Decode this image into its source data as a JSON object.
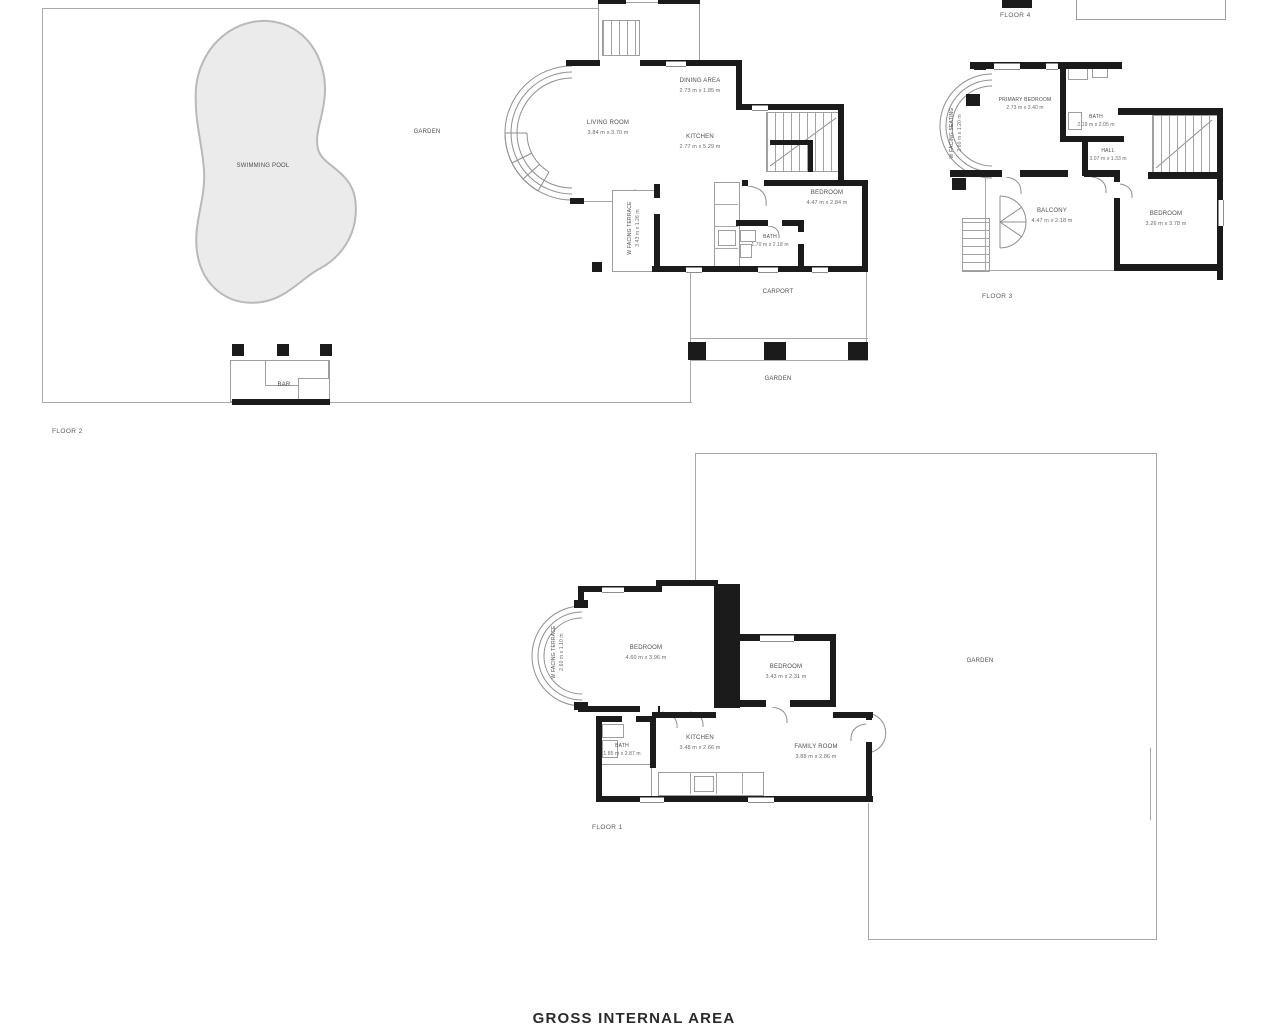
{
  "sheet": {
    "bottom_caption": "GROSS INTERNAL AREA"
  },
  "floor2": {
    "name": "FLOOR 2",
    "garden_label": "GARDEN",
    "garden_lower_label": "GARDEN",
    "pool_label": "SWIMMING POOL",
    "bar_label": "BAR",
    "carport_label": "CARPORT",
    "terrace": {
      "name": "W FACING TERRACE",
      "dims": "3.43 m x 1.26 m"
    },
    "rooms": {
      "dining": {
        "name": "DINING AREA",
        "dims": "2.73 m x 1.85 m"
      },
      "living": {
        "name": "LIVING ROOM",
        "dims": "3.84 m x 3.70 m"
      },
      "kitchen": {
        "name": "KITCHEN",
        "dims": "2.77 m x 5.29 m"
      },
      "bedroom": {
        "name": "BEDROOM",
        "dims": "4.47 m x 2.84 m"
      },
      "bath": {
        "name": "BATH",
        "dims": "1.70 m x 2.18 m"
      }
    }
  },
  "floor3": {
    "name": "FLOOR 3",
    "floor4_name": "FLOOR 4",
    "seating": {
      "name": "W FACING SEATING",
      "dims": "2.60 m x 1.20 m"
    },
    "rooms": {
      "primary": {
        "name": "PRIMARY BEDROOM",
        "dims": "2.73 m x 3.40 m"
      },
      "bath": {
        "name": "BATH",
        "dims": "2.19 m x 2.05 m"
      },
      "hall": {
        "name": "HALL",
        "dims": "3.07 m x 1.33 m"
      },
      "balcony": {
        "name": "BALCONY",
        "dims": "4.47 m x 2.18 m"
      },
      "bedroom": {
        "name": "BEDROOM",
        "dims": "3.26 m x 3.78 m"
      }
    }
  },
  "floor1": {
    "name": "FLOOR 1",
    "garden_label": "GARDEN",
    "terrace": {
      "name": "W FACING TERRACE",
      "dims": "2.60 m x 1.10 m"
    },
    "rooms": {
      "bedroom1": {
        "name": "BEDROOM",
        "dims": "4.60 m x 3.96 m"
      },
      "bedroom2": {
        "name": "BEDROOM",
        "dims": "3.43 m x 2.31 m"
      },
      "kitchen": {
        "name": "KITCHEN",
        "dims": "3.48 m x 2.66 m"
      },
      "family": {
        "name": "FAMILY ROOM",
        "dims": "3.88 m x 2.86 m"
      },
      "bath": {
        "name": "BATH",
        "dims": "1.85 m x 2.87 m"
      }
    }
  }
}
